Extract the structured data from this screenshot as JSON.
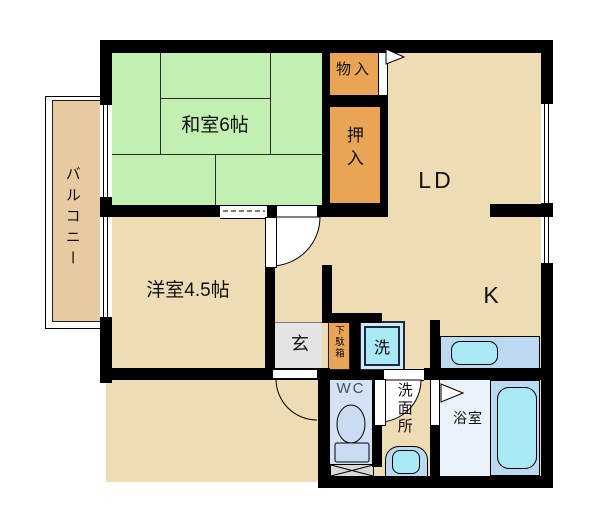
{
  "labels": {
    "washitsu": "和室6帖",
    "youshitsu": "洋室4.5帖",
    "living_dining": "LD",
    "kitchen": "K",
    "balcony": "バルコニー",
    "storage": "物入",
    "oshiire": "押入",
    "entrance": "玄",
    "shoe_cabinet": "下駄箱",
    "laundry": "洗",
    "toilet": "WC",
    "washroom": "洗面所",
    "bathroom": "浴室"
  },
  "colors": {
    "tatami": "#c2efb2",
    "floor": "#eedcb4",
    "balcony": "#e7caa2",
    "closet": "#e9a455",
    "genkan": "#e4e4e4",
    "wcfloor": "#d3e3f5",
    "bathfloor": "#e9f1f9",
    "fixture": "#bcd9f2",
    "water": "#a9e9f5",
    "toiletfill": "#c9dcf4",
    "hatch": "#d9d9d9",
    "wall": "#000000"
  }
}
